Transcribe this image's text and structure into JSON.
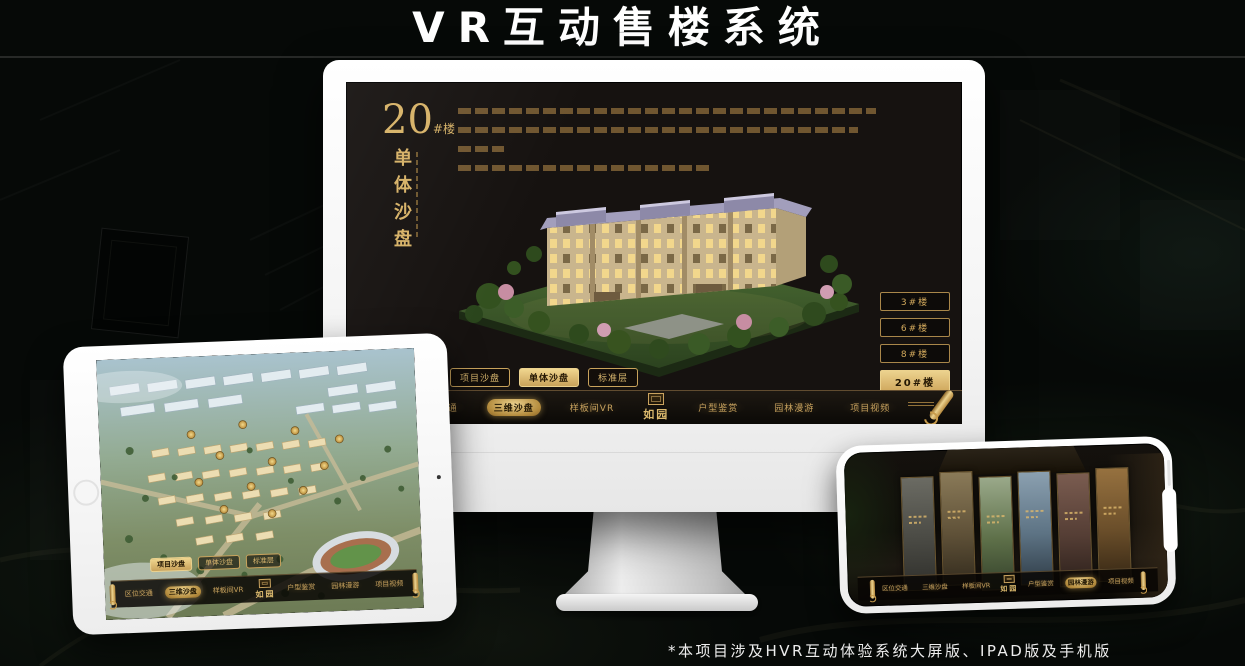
{
  "page": {
    "title": "VR互动售楼系统",
    "footnote": "*本项目涉及HVR互动体验系统大屏版、IPAD版及手机版"
  },
  "colors": {
    "accent_gold": "#d2ab60",
    "accent_gold_bright": "#ecd28e",
    "selected_text_dark": "#241703",
    "background": "#060907",
    "title_text": "#ffffff"
  },
  "monitor": {
    "floor_label": {
      "number": "20",
      "suffix": "#楼",
      "name": "单体沙盘"
    },
    "floor_buttons": [
      {
        "label": "3#楼",
        "active": false
      },
      {
        "label": "6#楼",
        "active": false
      },
      {
        "label": "8#楼",
        "active": false
      },
      {
        "label": "20#楼",
        "active": true
      }
    ],
    "subtabs": [
      {
        "label": "项目沙盘",
        "active": false
      },
      {
        "label": "单体沙盘",
        "active": true
      },
      {
        "label": "标准层",
        "active": false
      }
    ],
    "nav": {
      "left": [
        {
          "label": "区位交通",
          "active": false
        },
        {
          "label": "三维沙盘",
          "active": true
        },
        {
          "label": "样板间VR",
          "active": false
        }
      ],
      "logo": "如园",
      "right": [
        {
          "label": "户型鉴赏",
          "active": false
        },
        {
          "label": "园林漫游",
          "active": false
        },
        {
          "label": "项目视频",
          "active": false
        }
      ]
    }
  },
  "tablet": {
    "subtabs": [
      {
        "label": "项目沙盘",
        "active": true
      },
      {
        "label": "单体沙盘",
        "active": false
      },
      {
        "label": "标准层",
        "active": false
      }
    ],
    "nav": {
      "left": [
        {
          "label": "区位交通",
          "active": false
        },
        {
          "label": "三维沙盘",
          "active": true
        },
        {
          "label": "样板间VR",
          "active": false
        }
      ],
      "logo": "如园",
      "right": [
        {
          "label": "户型鉴赏",
          "active": false
        },
        {
          "label": "园林漫游",
          "active": false
        },
        {
          "label": "项目视频",
          "active": false
        }
      ]
    }
  },
  "phone": {
    "nav": {
      "left": [
        {
          "label": "区位交通",
          "active": false
        },
        {
          "label": "三维沙盘",
          "active": false
        },
        {
          "label": "样板间VR",
          "active": false
        }
      ],
      "logo": "如园",
      "right": [
        {
          "label": "户型鉴赏",
          "active": false
        },
        {
          "label": "园林漫游",
          "active": true
        },
        {
          "label": "项目视频",
          "active": false
        }
      ]
    }
  }
}
